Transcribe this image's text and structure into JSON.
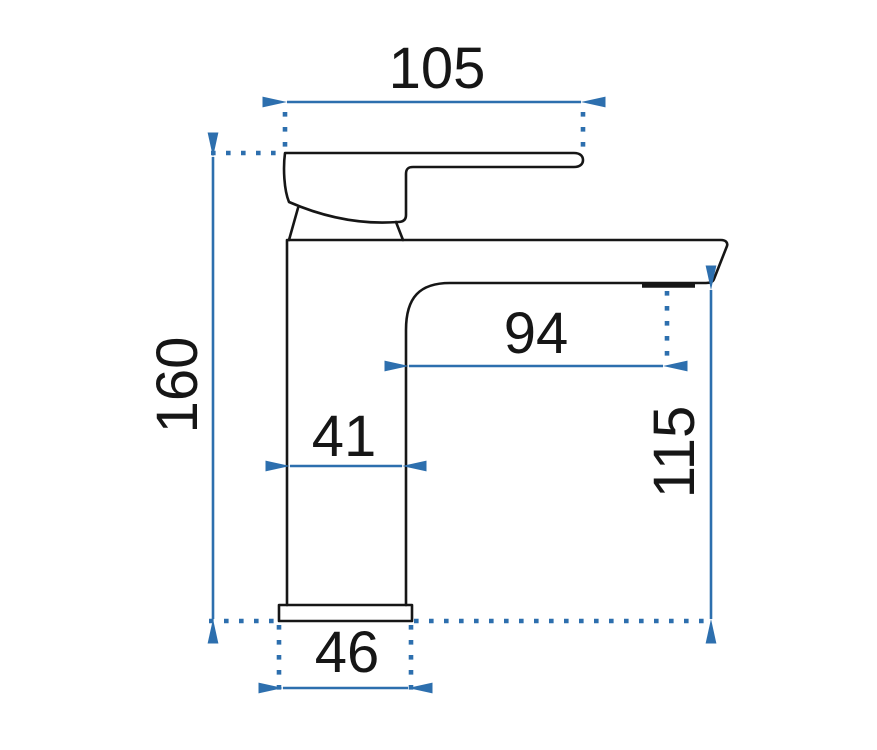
{
  "drawing": {
    "kind": "technical-dimension-drawing",
    "subject": "single-lever basin faucet, side view",
    "background": "#ffffff",
    "colors": {
      "dimension_blue": "#2d6fae",
      "outline_black": "#161616"
    },
    "dimensions": {
      "handle_top_width": "105",
      "overall_height": "160",
      "spout_reach": "94",
      "body_width": "41",
      "spout_to_base_height": "115",
      "base_width": "46"
    }
  }
}
